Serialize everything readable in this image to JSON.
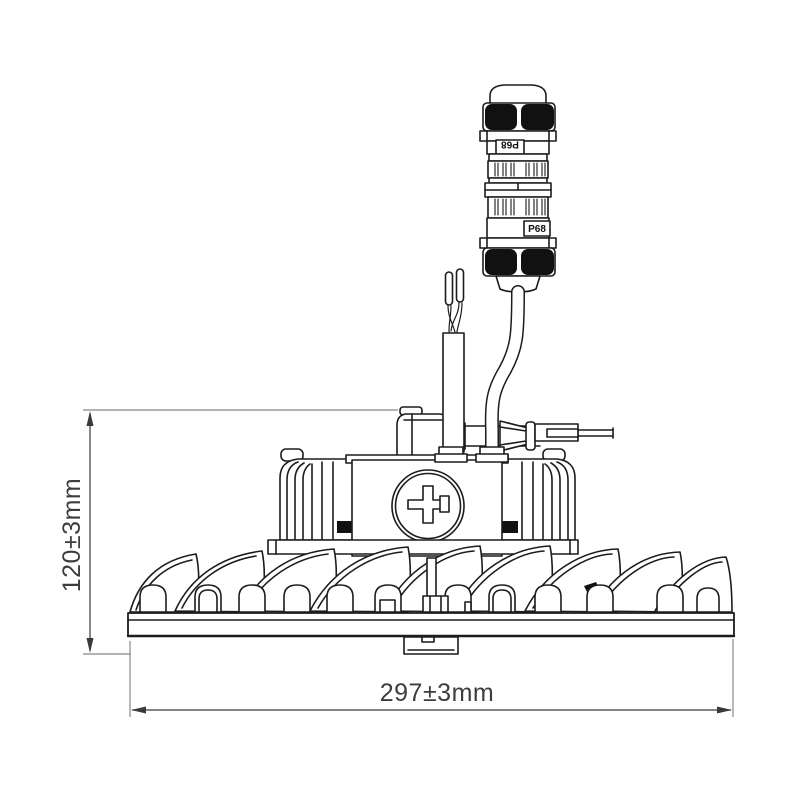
{
  "drawing": {
    "dimension_height_label": "120±3mm",
    "dimension_width_label": "297±3mm",
    "connector_label_top": "P68",
    "connector_label_bottom": "P68",
    "colors": {
      "line": "#1c1c1c",
      "solid_black": "#111111",
      "dimension_line": "#3a3a3a",
      "extension_line": "#9a9a9a",
      "text": "#3d3d3d",
      "background": "#ffffff"
    }
  }
}
